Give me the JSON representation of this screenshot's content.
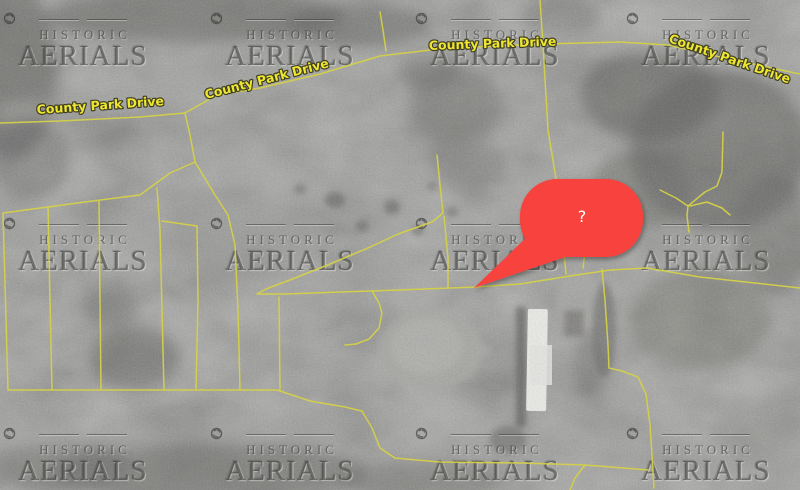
{
  "watermark": {
    "line1": "HISTORIC",
    "line2": "AERIALS",
    "icon": "aperture-icon",
    "positions": [
      {
        "x": 83,
        "y": 12
      },
      {
        "x": 290,
        "y": 12
      },
      {
        "x": 495,
        "y": 12
      },
      {
        "x": 706,
        "y": 12
      },
      {
        "x": 83,
        "y": 217
      },
      {
        "x": 290,
        "y": 217
      },
      {
        "x": 495,
        "y": 217
      },
      {
        "x": 706,
        "y": 217
      },
      {
        "x": 83,
        "y": 427
      },
      {
        "x": 290,
        "y": 427
      },
      {
        "x": 495,
        "y": 427
      },
      {
        "x": 706,
        "y": 427
      }
    ]
  },
  "marker": {
    "label": "?",
    "color": "#f7423d",
    "label_color": "#ffffff"
  },
  "map": {
    "road_color": "#d4d148",
    "label_color": "#eee631",
    "label_outline": "#3f3f23",
    "labels": [
      {
        "text": "County Park Drive",
        "x": 37,
        "y": 114,
        "rotate": -4
      },
      {
        "text": "County Park Drive",
        "x": 206,
        "y": 99,
        "rotate": -14.5
      },
      {
        "text": "County Park Drive",
        "x": 429,
        "y": 50,
        "rotate": -2
      },
      {
        "text": "County Park Drive",
        "x": 668,
        "y": 42,
        "rotate": 19
      }
    ],
    "roads": [
      [
        [
          0,
          123
        ],
        [
          60,
          121
        ],
        [
          140,
          117
        ],
        [
          185,
          113
        ],
        [
          217,
          95
        ],
        [
          260,
          88
        ],
        [
          320,
          74
        ],
        [
          380,
          56
        ],
        [
          430,
          50
        ],
        [
          470,
          47
        ],
        [
          543,
          44
        ],
        [
          620,
          42
        ],
        [
          668,
          45
        ],
        [
          720,
          57
        ],
        [
          800,
          74
        ]
      ],
      [
        [
          380,
          12
        ],
        [
          383,
          30
        ],
        [
          386,
          51
        ]
      ],
      [
        [
          540,
          0
        ],
        [
          543,
          45
        ],
        [
          548,
          130
        ],
        [
          557,
          185
        ],
        [
          563,
          240
        ],
        [
          566,
          274
        ]
      ],
      [
        [
          185,
          113
        ],
        [
          190,
          135
        ],
        [
          195,
          162
        ]
      ],
      [
        [
          195,
          162
        ],
        [
          170,
          173
        ],
        [
          140,
          195
        ],
        [
          100,
          200
        ],
        [
          3,
          213
        ],
        [
          8,
          390
        ]
      ],
      [
        [
          195,
          162
        ],
        [
          215,
          195
        ],
        [
          228,
          215
        ],
        [
          235,
          245
        ],
        [
          238,
          310
        ],
        [
          240,
          390
        ]
      ],
      [
        [
          157,
          188
        ],
        [
          160,
          230
        ],
        [
          162,
          310
        ],
        [
          164,
          390
        ]
      ],
      [
        [
          48,
          207
        ],
        [
          50,
          300
        ],
        [
          52,
          390
        ]
      ],
      [
        [
          99,
          201
        ],
        [
          100,
          300
        ],
        [
          101,
          390
        ]
      ],
      [
        [
          162,
          221
        ],
        [
          197,
          226
        ],
        [
          198,
          300
        ],
        [
          196,
          390
        ]
      ],
      [
        [
          279,
          297
        ],
        [
          280,
          390
        ]
      ],
      [
        [
          8,
          390
        ],
        [
          277,
          390
        ],
        [
          310,
          401
        ],
        [
          345,
          407
        ],
        [
          362,
          411
        ],
        [
          372,
          428
        ],
        [
          380,
          448
        ],
        [
          395,
          458
        ],
        [
          440,
          462
        ],
        [
          520,
          463
        ],
        [
          585,
          465
        ],
        [
          648,
          470
        ]
      ],
      [
        [
          437,
          155
        ],
        [
          440,
          185
        ],
        [
          443,
          213
        ],
        [
          432,
          222
        ],
        [
          398,
          234
        ],
        [
          368,
          248
        ],
        [
          330,
          264
        ],
        [
          295,
          278
        ],
        [
          266,
          289
        ],
        [
          257,
          294
        ],
        [
          285,
          294
        ],
        [
          340,
          292
        ],
        [
          400,
          290
        ],
        [
          475,
          287
        ],
        [
          520,
          284
        ],
        [
          570,
          276
        ],
        [
          610,
          270
        ],
        [
          647,
          268
        ],
        [
          700,
          277
        ],
        [
          755,
          283
        ],
        [
          800,
          288
        ]
      ],
      [
        [
          444,
          216
        ],
        [
          448,
          258
        ],
        [
          448,
          287
        ]
      ],
      [
        [
          372,
          291
        ],
        [
          379,
          303
        ],
        [
          382,
          313
        ],
        [
          379,
          328
        ],
        [
          369,
          339
        ],
        [
          356,
          344
        ],
        [
          345,
          345
        ]
      ],
      [
        [
          586,
          242
        ],
        [
          583,
          268
        ]
      ],
      [
        [
          602,
          269
        ],
        [
          605,
          300
        ],
        [
          608,
          345
        ],
        [
          609,
          368
        ],
        [
          622,
          371
        ],
        [
          638,
          377
        ],
        [
          646,
          394
        ],
        [
          650,
          425
        ],
        [
          652,
          455
        ],
        [
          654,
          488
        ]
      ],
      [
        [
          660,
          190
        ],
        [
          676,
          198
        ],
        [
          688,
          206
        ],
        [
          687,
          216
        ],
        [
          689,
          232
        ]
      ],
      [
        [
          688,
          206
        ],
        [
          705,
          192
        ],
        [
          717,
          186
        ],
        [
          722,
          172
        ],
        [
          723,
          132
        ]
      ],
      [
        [
          690,
          206
        ],
        [
          707,
          202
        ],
        [
          722,
          208
        ],
        [
          730,
          215
        ]
      ],
      [
        [
          585,
          465
        ],
        [
          575,
          478
        ],
        [
          570,
          490
        ]
      ]
    ]
  }
}
